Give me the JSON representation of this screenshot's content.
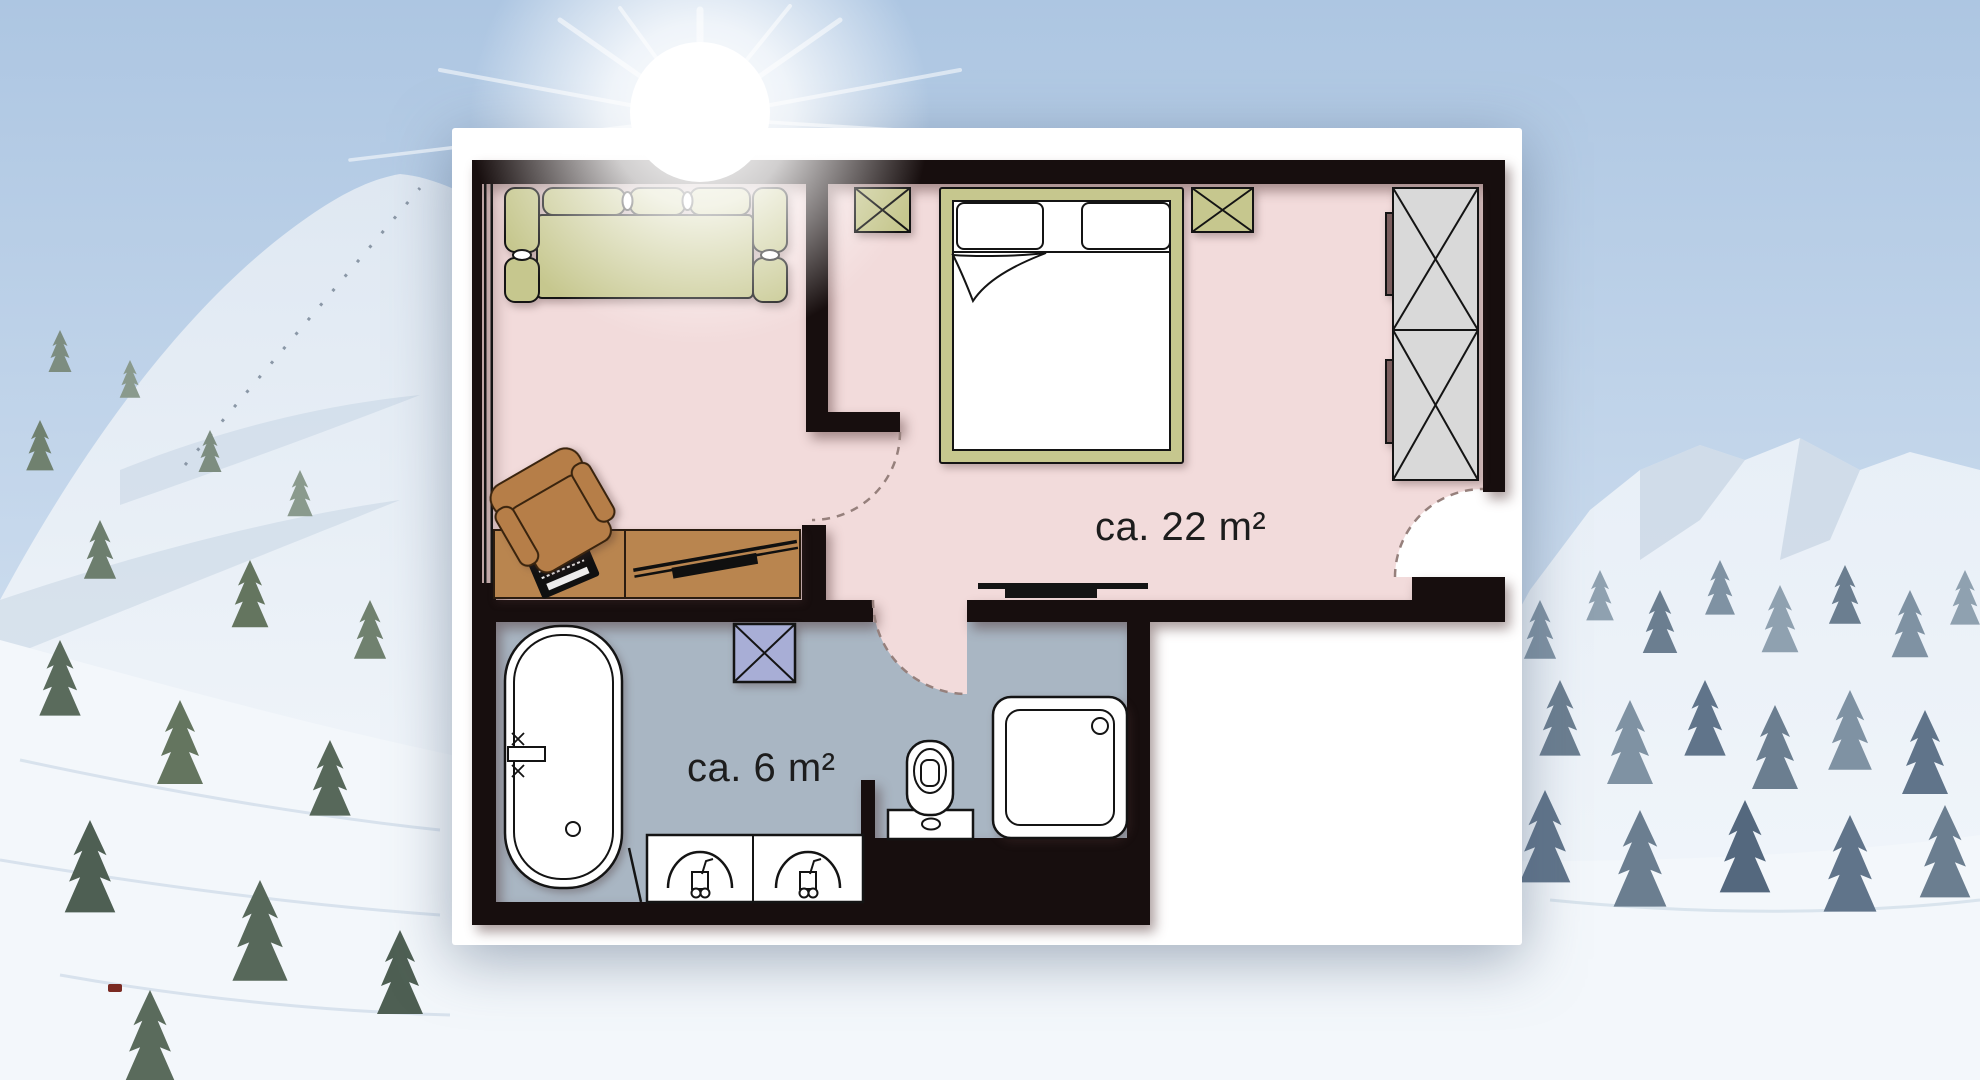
{
  "scene": {
    "description": "Hotel apartment floor plan on a white card over a sunny snowy alpine panorama",
    "background": "snow-covered mountains, frosted conifer forest, bright sun glare at top"
  },
  "rooms": [
    {
      "id": "living_bedroom",
      "area_label": "ca. 22 m²"
    },
    {
      "id": "bathroom",
      "area_label": "ca. 6 m²"
    }
  ],
  "furniture": {
    "living_bedroom": [
      "corner-sofa",
      "armchair",
      "desk",
      "laptop",
      "tv-board",
      "double-bed",
      "pillow",
      "pillow",
      "nightstand-left",
      "nightstand-right",
      "wardrobe",
      "wall-tv"
    ],
    "bathroom": [
      "bathtub",
      "tub-faucet",
      "ventilation-box",
      "double-washbasin",
      "toilet",
      "shower"
    ]
  },
  "colors": {
    "wall": "#170e0e",
    "card": "#ffffff",
    "room_pink": "#f2dbdb",
    "bath_blue": "#a9b6c3",
    "furniture_olive": "#c6c78e",
    "furniture_brown": "#b9854f",
    "chair_brown": "#b67e48",
    "wardrobe_gray": "#d9d9d9",
    "vent_periwinkle": "#a8aed6",
    "wardrobe_handle": "#7b5e5e",
    "outline": "#141414",
    "dash": "#96807c",
    "label_text": "#1d1d1d"
  }
}
